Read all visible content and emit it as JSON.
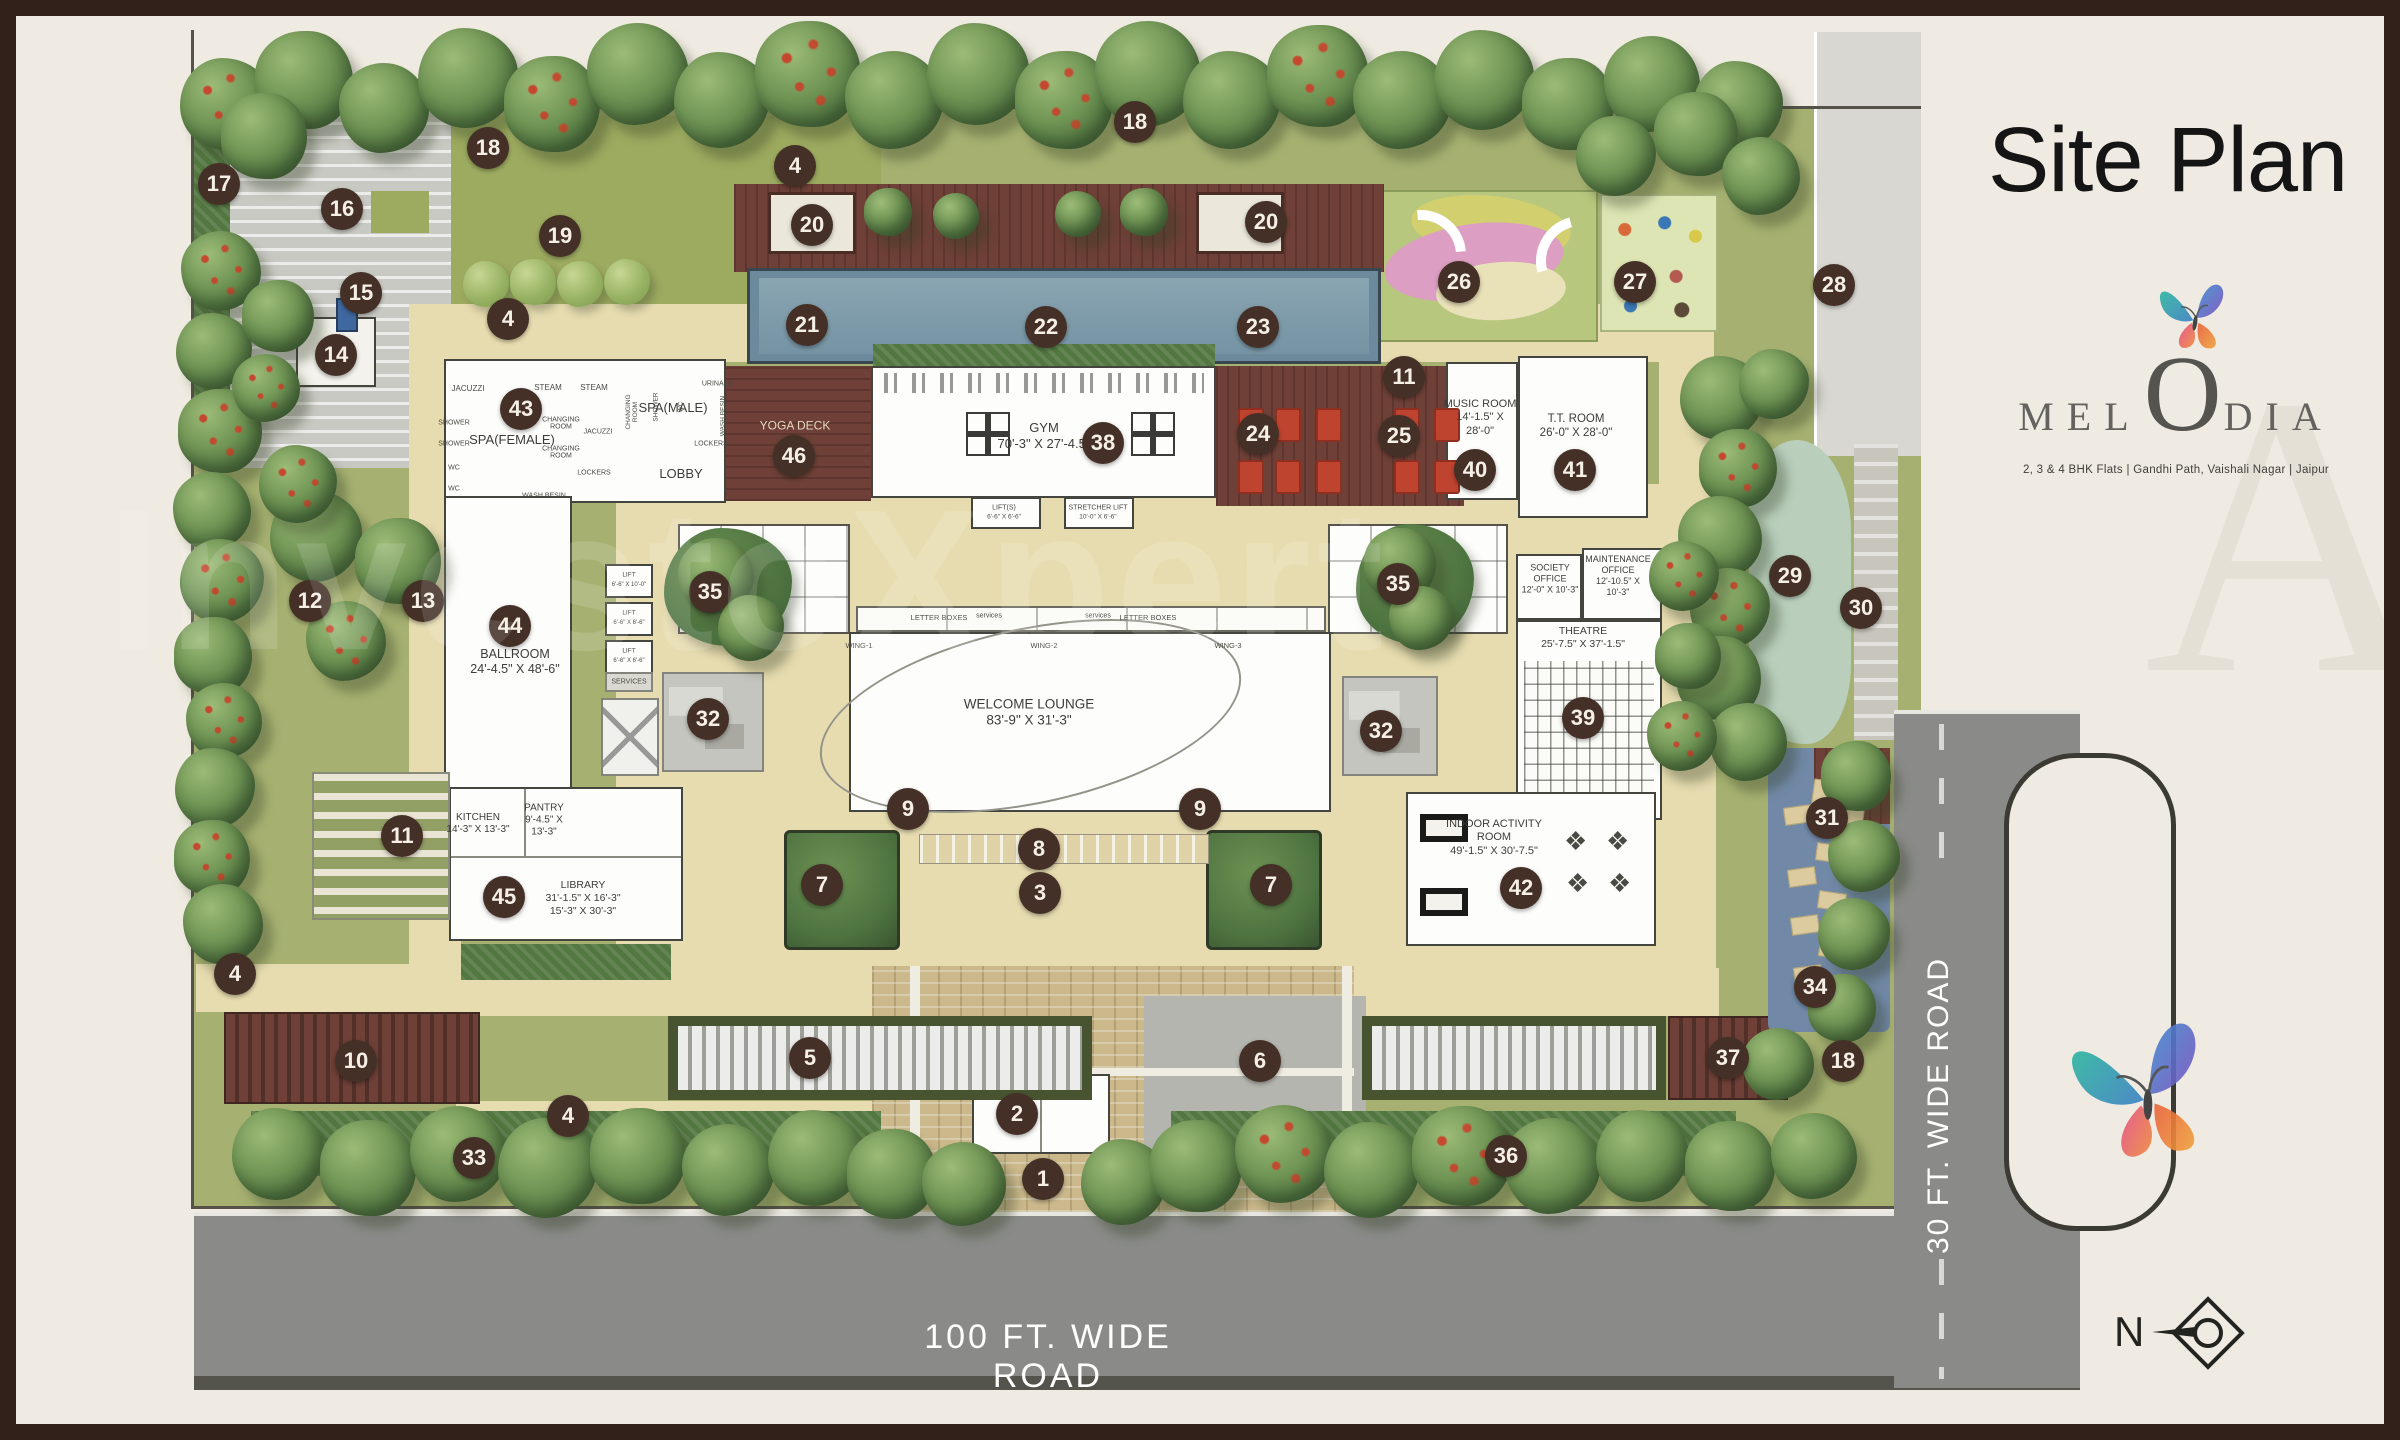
{
  "title": "Site Plan",
  "brand": {
    "pre": "MEL",
    "o": "O",
    "post": "DIA",
    "tagline": "2, 3 & 4 BHK Flats    |    Gandhi Path, Vaishali Nagar    |    Jaipur"
  },
  "roads": {
    "bottom_label": "100 FT. WIDE ROAD",
    "right_label": "30 FT. WIDE ROAD"
  },
  "compass": {
    "label": "N"
  },
  "watermark": {
    "text": "InvestoXpert",
    "letter": "A"
  },
  "colors": {
    "frame": "#31211a",
    "paper": "#f0ebe2",
    "site_green": "#a6b171",
    "path_tan": "#e7dcb0",
    "deck_brown": "#6e4037",
    "pool_blue": "#7e99a9",
    "water_blue": "#7189a6",
    "road_gray": "#8a8b88",
    "marker_brown": "#443026",
    "room_white": "#fdfdfb",
    "stream_green": "#b9cfbc",
    "play_pink": "#dc9ec2",
    "play_yellow": "#d2d06e",
    "chair_red": "#bf4430"
  },
  "markers": [
    {
      "n": "17",
      "x": 203,
      "y": 168
    },
    {
      "n": "18",
      "x": 472,
      "y": 132
    },
    {
      "n": "16",
      "x": 326,
      "y": 193
    },
    {
      "n": "19",
      "x": 544,
      "y": 220
    },
    {
      "n": "15",
      "x": 345,
      "y": 277
    },
    {
      "n": "14",
      "x": 320,
      "y": 339
    },
    {
      "n": "4",
      "x": 492,
      "y": 303
    },
    {
      "n": "4",
      "x": 779,
      "y": 150
    },
    {
      "n": "18",
      "x": 1119,
      "y": 106
    },
    {
      "n": "20",
      "x": 796,
      "y": 209
    },
    {
      "n": "20",
      "x": 1250,
      "y": 206
    },
    {
      "n": "21",
      "x": 791,
      "y": 309
    },
    {
      "n": "22",
      "x": 1030,
      "y": 311
    },
    {
      "n": "23",
      "x": 1242,
      "y": 311
    },
    {
      "n": "26",
      "x": 1443,
      "y": 266
    },
    {
      "n": "27",
      "x": 1619,
      "y": 266
    },
    {
      "n": "28",
      "x": 1818,
      "y": 269
    },
    {
      "n": "11",
      "x": 1388,
      "y": 361
    },
    {
      "n": "24",
      "x": 1242,
      "y": 418
    },
    {
      "n": "25",
      "x": 1383,
      "y": 420
    },
    {
      "n": "43",
      "x": 505,
      "y": 393
    },
    {
      "n": "46",
      "x": 778,
      "y": 440
    },
    {
      "n": "38",
      "x": 1087,
      "y": 427
    },
    {
      "n": "40",
      "x": 1459,
      "y": 454
    },
    {
      "n": "41",
      "x": 1559,
      "y": 454
    },
    {
      "n": "12",
      "x": 294,
      "y": 585
    },
    {
      "n": "13",
      "x": 407,
      "y": 585
    },
    {
      "n": "44",
      "x": 494,
      "y": 610
    },
    {
      "n": "35",
      "x": 694,
      "y": 576
    },
    {
      "n": "35",
      "x": 1382,
      "y": 568
    },
    {
      "n": "29",
      "x": 1774,
      "y": 560
    },
    {
      "n": "30",
      "x": 1845,
      "y": 592
    },
    {
      "n": "32",
      "x": 692,
      "y": 703
    },
    {
      "n": "32",
      "x": 1365,
      "y": 715
    },
    {
      "n": "39",
      "x": 1567,
      "y": 702
    },
    {
      "n": "9",
      "x": 892,
      "y": 793
    },
    {
      "n": "9",
      "x": 1184,
      "y": 793
    },
    {
      "n": "8",
      "x": 1023,
      "y": 833
    },
    {
      "n": "3",
      "x": 1024,
      "y": 877
    },
    {
      "n": "7",
      "x": 806,
      "y": 869
    },
    {
      "n": "7",
      "x": 1255,
      "y": 869
    },
    {
      "n": "11",
      "x": 386,
      "y": 820
    },
    {
      "n": "45",
      "x": 488,
      "y": 881
    },
    {
      "n": "42",
      "x": 1505,
      "y": 872
    },
    {
      "n": "31",
      "x": 1811,
      "y": 802
    },
    {
      "n": "34",
      "x": 1799,
      "y": 971
    },
    {
      "n": "4",
      "x": 219,
      "y": 958
    },
    {
      "n": "10",
      "x": 340,
      "y": 1045
    },
    {
      "n": "5",
      "x": 794,
      "y": 1042
    },
    {
      "n": "6",
      "x": 1244,
      "y": 1045
    },
    {
      "n": "2",
      "x": 1001,
      "y": 1098
    },
    {
      "n": "1",
      "x": 1027,
      "y": 1163
    },
    {
      "n": "4",
      "x": 552,
      "y": 1100
    },
    {
      "n": "33",
      "x": 458,
      "y": 1142
    },
    {
      "n": "36",
      "x": 1490,
      "y": 1140
    },
    {
      "n": "37",
      "x": 1712,
      "y": 1042
    },
    {
      "n": "18",
      "x": 1827,
      "y": 1045
    }
  ],
  "room_labels": [
    {
      "id": "spa-female",
      "x": 496,
      "y": 424,
      "s": 13,
      "lines": [
        "SPA(FEMALE)"
      ]
    },
    {
      "id": "spa-male",
      "x": 657,
      "y": 392,
      "s": 13,
      "lines": [
        "SPA(MALE)"
      ]
    },
    {
      "id": "lobby",
      "x": 665,
      "y": 458,
      "s": 13,
      "lines": [
        "LOBBY"
      ]
    },
    {
      "id": "yoga-deck",
      "x": 779,
      "y": 410,
      "s": 12,
      "light": true,
      "lines": [
        "YOGA DECK"
      ]
    },
    {
      "id": "gym",
      "x": 1028,
      "y": 420,
      "s": 13,
      "lines": [
        "GYM",
        "70'-3\" X 27'-4.5\""
      ]
    },
    {
      "id": "music-room",
      "x": 1464,
      "y": 402,
      "s": 11,
      "lines": [
        "MUSIC ROOM",
        "14'-1.5\" X",
        "28'-0\""
      ]
    },
    {
      "id": "tt-room",
      "x": 1560,
      "y": 410,
      "s": 11.5,
      "lines": [
        "T.T. ROOM",
        "26'-0\" X 28'-0\""
      ]
    },
    {
      "id": "ballroom",
      "x": 499,
      "y": 646,
      "s": 12.5,
      "lines": [
        "BALLROOM",
        "24'-4.5\" X 48'-6\""
      ]
    },
    {
      "id": "welcome-lounge",
      "x": 1013,
      "y": 697,
      "s": 13.5,
      "lines": [
        "WELCOME LOUNGE",
        "83'-9\" X 31'-3\""
      ]
    },
    {
      "id": "kitchen",
      "x": 462,
      "y": 808,
      "s": 10,
      "lines": [
        "KITCHEN",
        "14'-3\" X 13'-3\""
      ]
    },
    {
      "id": "pantry",
      "x": 528,
      "y": 805,
      "s": 10,
      "lines": [
        "PANTRY",
        "9'-4.5\" X",
        "13'-3\""
      ]
    },
    {
      "id": "library",
      "x": 567,
      "y": 882,
      "s": 10.5,
      "lines": [
        "LIBRARY",
        "31'-1.5\" X 16'-3\"",
        "15'-3\" X 30'-3\""
      ]
    },
    {
      "id": "society-office",
      "x": 1534,
      "y": 563,
      "s": 9,
      "lines": [
        "SOCIETY",
        "OFFICE",
        "12'-0\" X 10'-3\""
      ]
    },
    {
      "id": "maintenance-office",
      "x": 1602,
      "y": 560,
      "s": 9,
      "lines": [
        "MAINTENANCE",
        "OFFICE",
        "12'-10.5\" X",
        "10'-3\""
      ]
    },
    {
      "id": "theatre",
      "x": 1567,
      "y": 622,
      "s": 10.5,
      "lines": [
        "THEATRE",
        "25'-7.5\" X 37'-1.5\""
      ]
    },
    {
      "id": "indoor-activity-room",
      "x": 1478,
      "y": 822,
      "s": 11,
      "lines": [
        "INDOOR ACTIVITY",
        "ROOM",
        "49'-1.5\" X 30'-7.5\""
      ]
    }
  ],
  "small_labels": [
    {
      "t": "JACUZZI",
      "x": 452,
      "y": 373,
      "s": 8
    },
    {
      "t": "STEAM",
      "x": 532,
      "y": 372,
      "s": 8
    },
    {
      "t": "STEAM",
      "x": 578,
      "y": 372,
      "s": 8
    },
    {
      "t": "SHOWER",
      "x": 438,
      "y": 407,
      "s": 7
    },
    {
      "t": "SHOWER",
      "x": 438,
      "y": 428,
      "s": 7
    },
    {
      "t": "WC",
      "x": 438,
      "y": 452,
      "s": 7
    },
    {
      "t": "WC",
      "x": 438,
      "y": 473,
      "s": 7
    },
    {
      "t": "CHANGING ROOM",
      "x": 545,
      "y": 408,
      "s": 7,
      "w": 44
    },
    {
      "t": "CHANGING ROOM",
      "x": 545,
      "y": 437,
      "s": 7,
      "w": 44
    },
    {
      "t": "JACUZZI",
      "x": 582,
      "y": 416,
      "s": 7
    },
    {
      "t": "LOCKERS",
      "x": 578,
      "y": 457,
      "s": 7
    },
    {
      "t": "WASH BESIN",
      "x": 528,
      "y": 480,
      "s": 7
    },
    {
      "t": "CHANGING ROOM",
      "x": 617,
      "y": 396,
      "s": 6.5,
      "r": -90,
      "w": 42
    },
    {
      "t": "SHOWER",
      "x": 641,
      "y": 391,
      "s": 6.5,
      "r": -90
    },
    {
      "t": "WC",
      "x": 666,
      "y": 391,
      "s": 6.5,
      "r": -90
    },
    {
      "t": "URINALS",
      "x": 701,
      "y": 368,
      "s": 7
    },
    {
      "t": "WASH BESIN",
      "x": 708,
      "y": 400,
      "s": 6.5,
      "r": -90,
      "w": 42
    },
    {
      "t": "LOCKERS",
      "x": 695,
      "y": 428,
      "s": 7
    },
    {
      "t": "LIFT(S)",
      "x": 988,
      "y": 492,
      "s": 7
    },
    {
      "t": "6'-6\" X 6'-6\"",
      "x": 988,
      "y": 502,
      "s": 6.5
    },
    {
      "t": "STRETCHER LIFT",
      "x": 1082,
      "y": 492,
      "s": 7
    },
    {
      "t": "10'-0\" X 6'-6\"",
      "x": 1082,
      "y": 502,
      "s": 6.5
    },
    {
      "t": "LIFT",
      "x": 613,
      "y": 560,
      "s": 6.5
    },
    {
      "t": "6'-6\" X 10'-0\"",
      "x": 613,
      "y": 569,
      "s": 6
    },
    {
      "t": "LIFT",
      "x": 613,
      "y": 598,
      "s": 6.5
    },
    {
      "t": "6'-6\" X 6'-6\"",
      "x": 613,
      "y": 607,
      "s": 6
    },
    {
      "t": "LIFT",
      "x": 613,
      "y": 636,
      "s": 6.5
    },
    {
      "t": "6'-6\" X 6'-6\"",
      "x": 613,
      "y": 645,
      "s": 6
    },
    {
      "t": "SERVICES",
      "x": 613,
      "y": 666,
      "s": 7
    },
    {
      "t": "LETTER BOXES",
      "x": 923,
      "y": 602,
      "s": 7.5
    },
    {
      "t": "LETTER BOXES",
      "x": 1132,
      "y": 602,
      "s": 7.5
    },
    {
      "t": "services",
      "x": 973,
      "y": 600,
      "s": 7
    },
    {
      "t": "services",
      "x": 1082,
      "y": 600,
      "s": 7
    },
    {
      "t": "WING-1",
      "x": 843,
      "y": 630,
      "s": 7.5
    },
    {
      "t": "WING-2",
      "x": 1028,
      "y": 630,
      "s": 7.5
    },
    {
      "t": "WING-3",
      "x": 1212,
      "y": 630,
      "s": 7.5
    }
  ]
}
